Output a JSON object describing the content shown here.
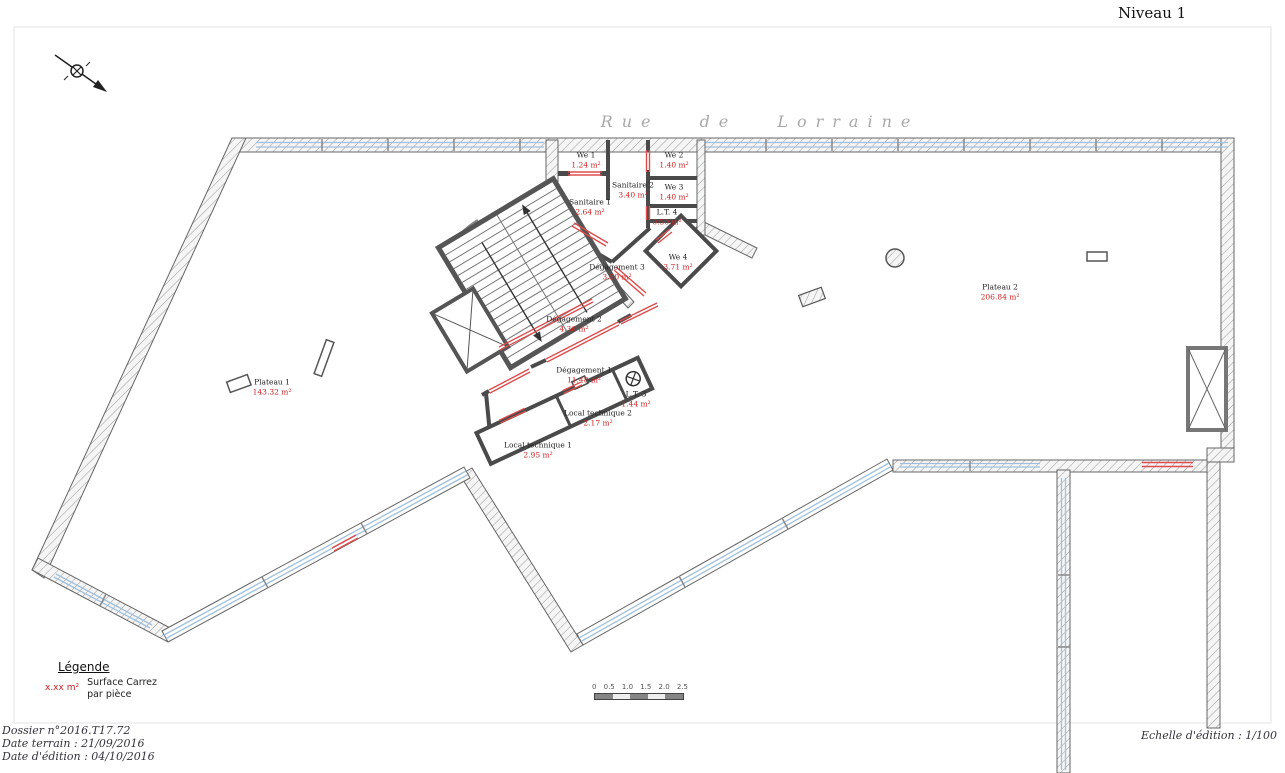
{
  "title": "Niveau 1",
  "street_name": "Rue de Lorraine",
  "rooms": [
    {
      "name": "We 1",
      "area": "1.24 m²"
    },
    {
      "name": "We 2",
      "area": "1.40 m²"
    },
    {
      "name": "We 3",
      "area": "1.40 m²"
    },
    {
      "name": "Sanitaire 2",
      "area": "3.40 m²"
    },
    {
      "name": "Sanitaire 1",
      "area": "2.64 m²"
    },
    {
      "name": "L.T. 4",
      "area": "0.50 m²"
    },
    {
      "name": "We 4",
      "area": "3.71 m²"
    },
    {
      "name": "Dégagement 3",
      "area": "3.50 m²"
    },
    {
      "name": "Dégagement 2",
      "area": "4.36 m²"
    },
    {
      "name": "Dégagement 1",
      "area": "11.48 m²"
    },
    {
      "name": "L.T. 3",
      "area": "1.44 m²"
    },
    {
      "name": "Local technique 2",
      "area": "2.17 m²"
    },
    {
      "name": "Local technique 1",
      "area": "2.95 m²"
    },
    {
      "name": "Plateau 1",
      "area": "143.32 m²"
    },
    {
      "name": "Plateau 2",
      "area": "206.84 m²"
    }
  ],
  "legend": {
    "heading": "Légende",
    "sample": "x.xx m²",
    "desc1": "Surface Carrez",
    "desc2": "par pièce"
  },
  "scalebar": {
    "ticks": [
      "0",
      "0.5",
      "1.0",
      "1.5",
      "2.0",
      "2.5"
    ]
  },
  "footer": {
    "dossier": "Dossier n°2016.T17.72",
    "date_terrain": "Date terrain : 21/09/2016",
    "date_edition": "Date d'édition : 04/10/2016",
    "echelle": "Echelle d'édition : 1/100"
  },
  "icons": {
    "north": "north-arrow",
    "fan": "extractor-fan",
    "elevator": "elevator-shaft-cross"
  },
  "colors": {
    "area_text": "#cc2222",
    "opening_red": "#dd4d4d",
    "window_blue": "#9fc0de",
    "wall_gray": "#4a4a4a",
    "street_gray": "#a9a9a9"
  }
}
